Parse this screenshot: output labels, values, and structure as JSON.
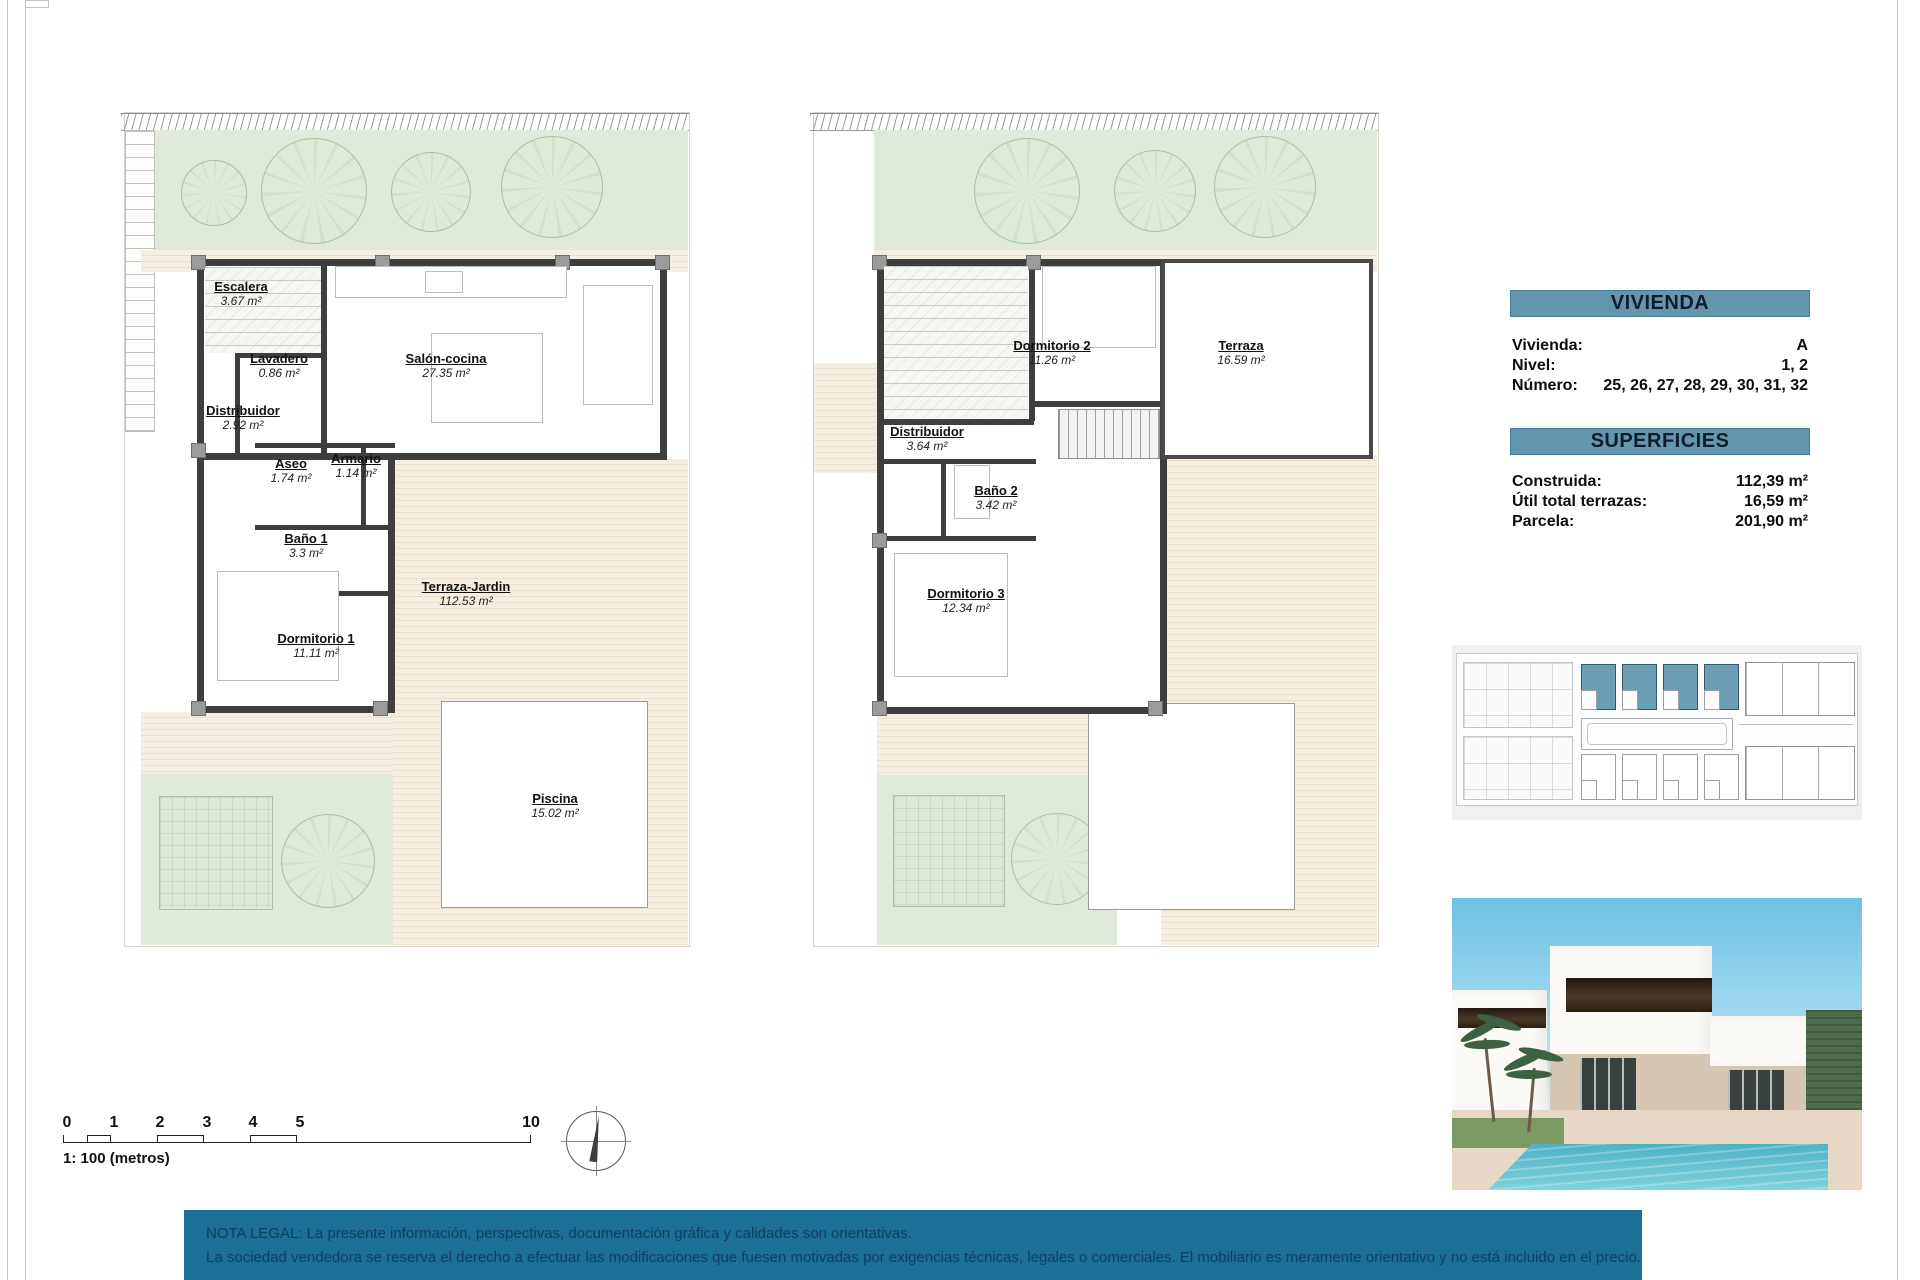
{
  "plans": {
    "ground": {
      "rooms": [
        {
          "name": "Escalera",
          "area": "3.67 m²"
        },
        {
          "name": "Lavadero",
          "area": "0.86 m²"
        },
        {
          "name": "Salón-cocina",
          "area": "27.35 m²"
        },
        {
          "name": "Distribuidor",
          "area": "2.92 m²"
        },
        {
          "name": "Aseo",
          "area": "1.74 m²"
        },
        {
          "name": "Armario",
          "area": "1.14 m²"
        },
        {
          "name": "Baño 1",
          "area": "3.3 m²"
        },
        {
          "name": "Dormitorio 1",
          "area": "11.11 m²"
        },
        {
          "name": "Terraza-Jardin",
          "area": "112.53 m²"
        },
        {
          "name": "Piscina",
          "area": "15.02 m²"
        }
      ]
    },
    "first": {
      "rooms": [
        {
          "name": "Dormitorio 2",
          "area": "11.26 m²"
        },
        {
          "name": "Terraza",
          "area": "16.59 m²"
        },
        {
          "name": "Distribuidor",
          "area": "3.64 m²"
        },
        {
          "name": "Baño 2",
          "area": "3.42 m²"
        },
        {
          "name": "Dormitorio 3",
          "area": "12.34 m²"
        }
      ]
    }
  },
  "info": {
    "vivienda": {
      "title": "VIVIENDA",
      "rows": [
        {
          "label": "Vivienda:",
          "value": "A"
        },
        {
          "label": "Nivel:",
          "value": "1, 2"
        },
        {
          "label": "Número:",
          "value": "25, 26, 27, 28, 29, 30, 31, 32"
        }
      ]
    },
    "superficies": {
      "title": "SUPERFICIES",
      "rows": [
        {
          "label": "Construida:",
          "value": "112,39 m²"
        },
        {
          "label": "Útil total terrazas:",
          "value": "16,59 m²"
        },
        {
          "label": "Parcela:",
          "value": "201,90 m²"
        }
      ]
    }
  },
  "scale": {
    "caption": "1: 100 (metros)",
    "ticks": [
      "0",
      "1",
      "2",
      "3",
      "4",
      "5",
      "10"
    ]
  },
  "legal": {
    "line1": "NOTA LEGAL: La presente información, perspectivas, documentación gráfica y calidades son orientativas.",
    "line2": "La sociedad vendedora se reserva el derecho a efectuar las modificaciones que fuesen motivadas por exigencias técnicas, legales o comerciales. El mobiliario es meramente orientativo y no está incluido en el precio."
  },
  "colors": {
    "header_bar": "#6396ae",
    "legal_bg": "#1c7095",
    "legal_text": "#10405f",
    "highlight_unit": "#6d9cb5",
    "garden": "#e0eadb",
    "terrace": "#f0e6d6",
    "wall": "#3e3e3e"
  }
}
